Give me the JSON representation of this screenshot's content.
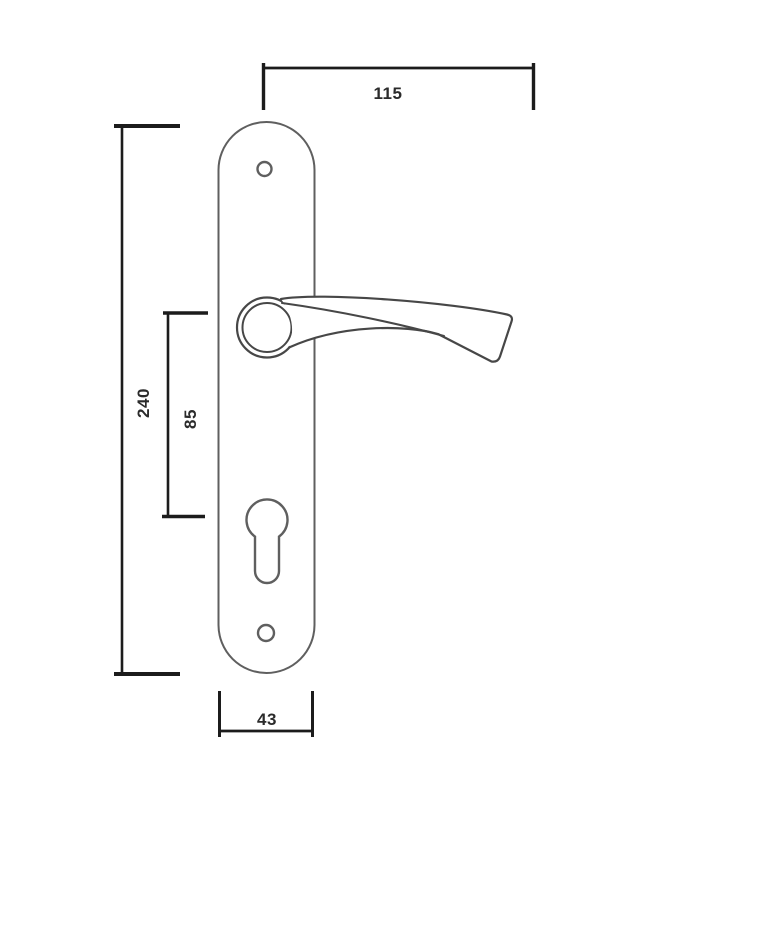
{
  "page": {
    "background": "#ffffff"
  },
  "dimensions": {
    "handle_length": {
      "value": "115"
    },
    "plate_height": {
      "value": "240"
    },
    "handle_to_cylinder": {
      "value": "85"
    },
    "plate_width": {
      "value": "43"
    }
  },
  "colors": {
    "dimension_line": "#1c1c1c",
    "part_outline": "#5f5f5f",
    "handle_outline": "#474747",
    "label_text": "#2b2b2b"
  }
}
